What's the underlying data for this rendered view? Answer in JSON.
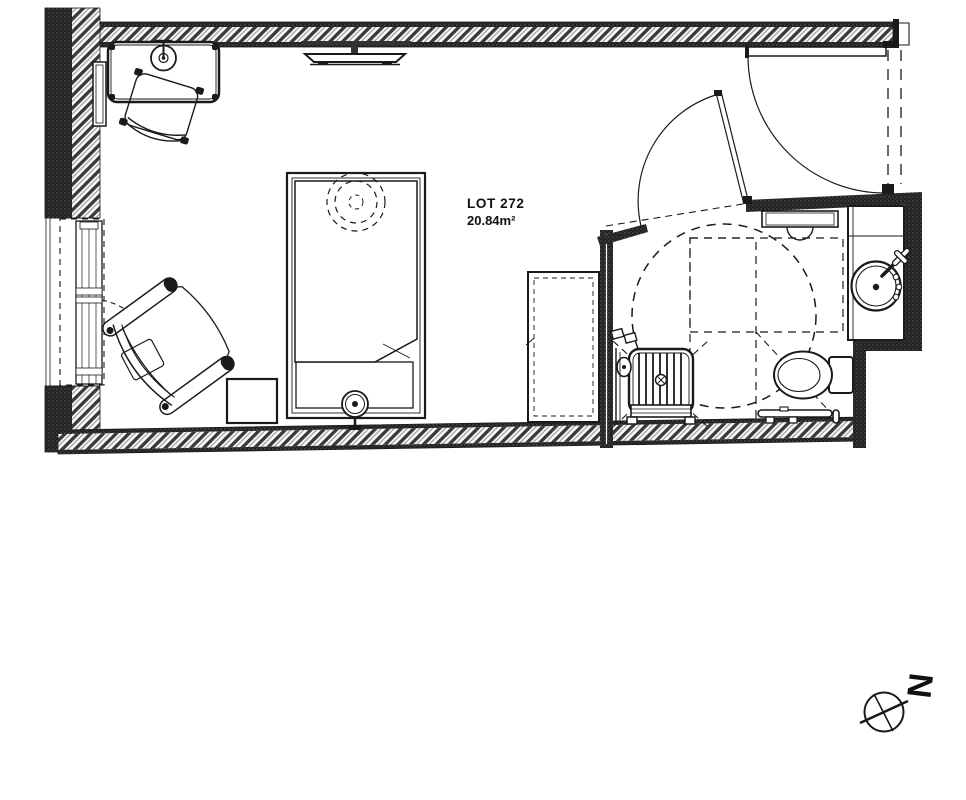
{
  "page": {
    "kind": "architectural-floor-plan",
    "sheet": "unit plan"
  },
  "labels": {
    "lot": "LOT 272",
    "area": "20.84m²",
    "north": "N"
  },
  "colors": {
    "ink": "#1a1a1a",
    "wall-dark": "#232323",
    "hatch-stripe": "#3a3a3a",
    "background": "#ffffff"
  },
  "rooms": [
    {
      "name": "bedroom-living"
    },
    {
      "name": "accessible-bathroom"
    },
    {
      "name": "entrance-vestibule"
    }
  ],
  "elements": [
    "exterior-walls-hatched",
    "window-left",
    "window-swing-dashed",
    "entrance-door-with-swing",
    "bathroom-door-with-swing",
    "desk",
    "desk-lamp",
    "desk-chair",
    "radiator",
    "wall-tv",
    "bed",
    "mattress-folded-corner",
    "ceiling-light-dashed",
    "wall-sconce",
    "armchair",
    "side-table",
    "wardrobe-dashed",
    "shower-seat-slatted",
    "shower-drain",
    "shower-valves",
    "shower-head",
    "accessibility-turning-circle",
    "accessibility-zones-dashed",
    "towel-rail",
    "vanity-counter",
    "washbasin",
    "faucet-cross-handle",
    "toilet",
    "grab-bar",
    "north-arrow"
  ]
}
